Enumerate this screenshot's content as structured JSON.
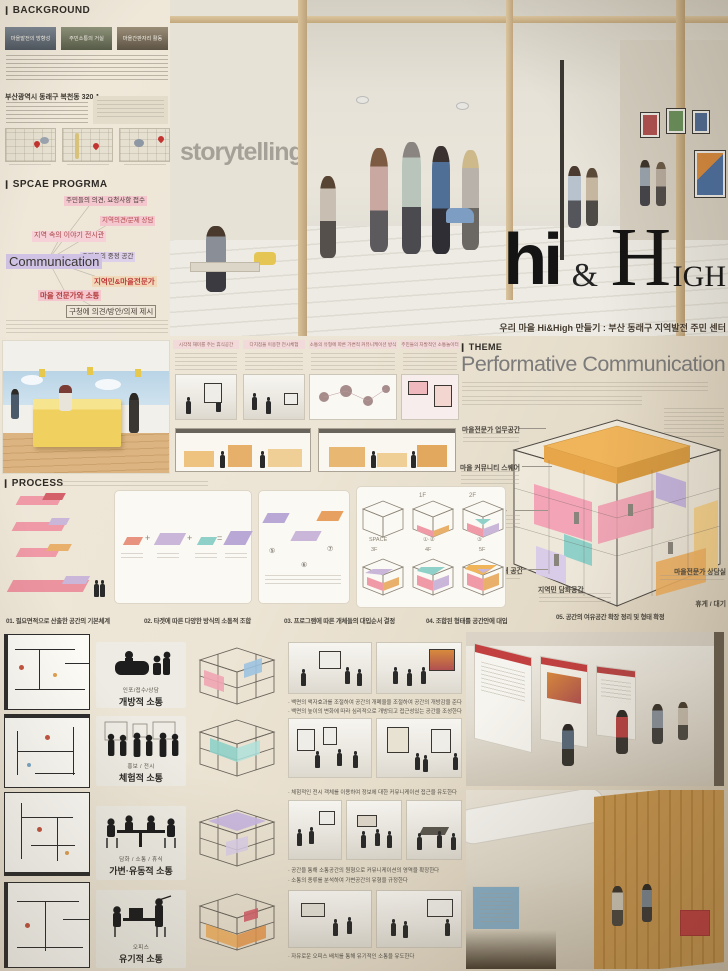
{
  "background": {
    "title": "BACKGROUND",
    "thumbs": [
      "마을발전의 방향성",
      "주민소통의 거실",
      "마을간판자리 활동"
    ],
    "site_title": "부산광역시 동래구 복천동 320-1"
  },
  "space_program": {
    "title": "SPCAE PROGRMA",
    "center": "Communication",
    "nodes": [
      "주민들의 의견, 요청사항 접수",
      "지역의견/문제 상담",
      "지역 속의 이야기 전시관",
      "주민들의 중정 공간",
      "지역민&마을전문가",
      "마을 전문가와 소통",
      "구청에 의견/방안/의제 제시"
    ]
  },
  "hero": {
    "wall_text": "storytelling",
    "logo_hi": "hi",
    "amp": "&",
    "logo_h": "H",
    "logo_igh": "IGH",
    "subtitle": "우리 마을 Hi&High 만들기 : 부산 동래구 지역발전 주민 센터"
  },
  "theme": {
    "label": "THEME",
    "headline": "Performative Communication",
    "cube_labels": [
      "마을전문가 업무공간",
      "마을 커뮤니티 스퀘어",
      "지역소개 전시관",
      "인포메이션 / 소개 공간",
      "지역민 담화공간",
      "마을전문가 상담실",
      "휴게 / 대기"
    ]
  },
  "middle_panels": {
    "headers": [
      "시각적 재미를 주는 휴식공간",
      "다지점을 이용한 전시체험",
      "소통의 유형에 따른 가변적 커뮤니케이션 방식",
      "주민들의 자발적인 소통놀이터"
    ]
  },
  "process": {
    "title": "PROCESS",
    "steps": [
      "01. 필요면적으로 산출한 공간의 기본체계",
      "02. 타겟에 따른 다양한 방식의 소통적 조합",
      "03. 프로그램에 따른 개체들의 대입순서 결정",
      "04. 조합된 형태를 공간안에 대입",
      "05. 공간의 여유공간 확장 정리 및 형태 확정"
    ],
    "cube_row1": [
      "SPACE",
      "①·②",
      "③"
    ],
    "cube_row2": [
      "3F",
      "4F",
      "5F"
    ],
    "floor_tags": [
      "1F",
      "2F"
    ],
    "ops": [
      "+",
      "+",
      "=",
      "⑤",
      "⑥",
      "⑦"
    ]
  },
  "bottom": {
    "rows": [
      {
        "category": "인포/접수/상담",
        "label": "개방적 소통",
        "bullets": [
          "백면의 액자효과를 조절하여 공간의 개폐율을 조절하여 공간의 개방감을 준다",
          "백면의 높이의 변화에 따라 심리적으로 개방되고 접근성있는 공간을 조성한다"
        ]
      },
      {
        "category": "홍보 / 전시",
        "label": "체험적 소통",
        "bullets": [
          "체험적인 전시 객체를 이용하여 정보에 대한 커뮤니케이션 접근을 유도한다"
        ]
      },
      {
        "category": "담화 / 소통 / 휴식",
        "label": "가변·유동적 소통",
        "bullets": [
          "공간을 통해 소통공간의 원형으로 커뮤니케이션의 영역을 확장한다",
          "소통의 종류를 분석하여 가변공간의 유형을 규정한다"
        ]
      },
      {
        "category": "오피스",
        "label": "유기적 소통",
        "bullets": [
          "자유로운 오피스 배치를 통해 유기적인 소통을 유도한다"
        ]
      }
    ]
  },
  "colors": {
    "pink": "#f0a4b2",
    "orange": "#f0b45a",
    "purple": "#c5b4dd",
    "teal": "#8fd0c8",
    "red_accent": "#c24040"
  }
}
